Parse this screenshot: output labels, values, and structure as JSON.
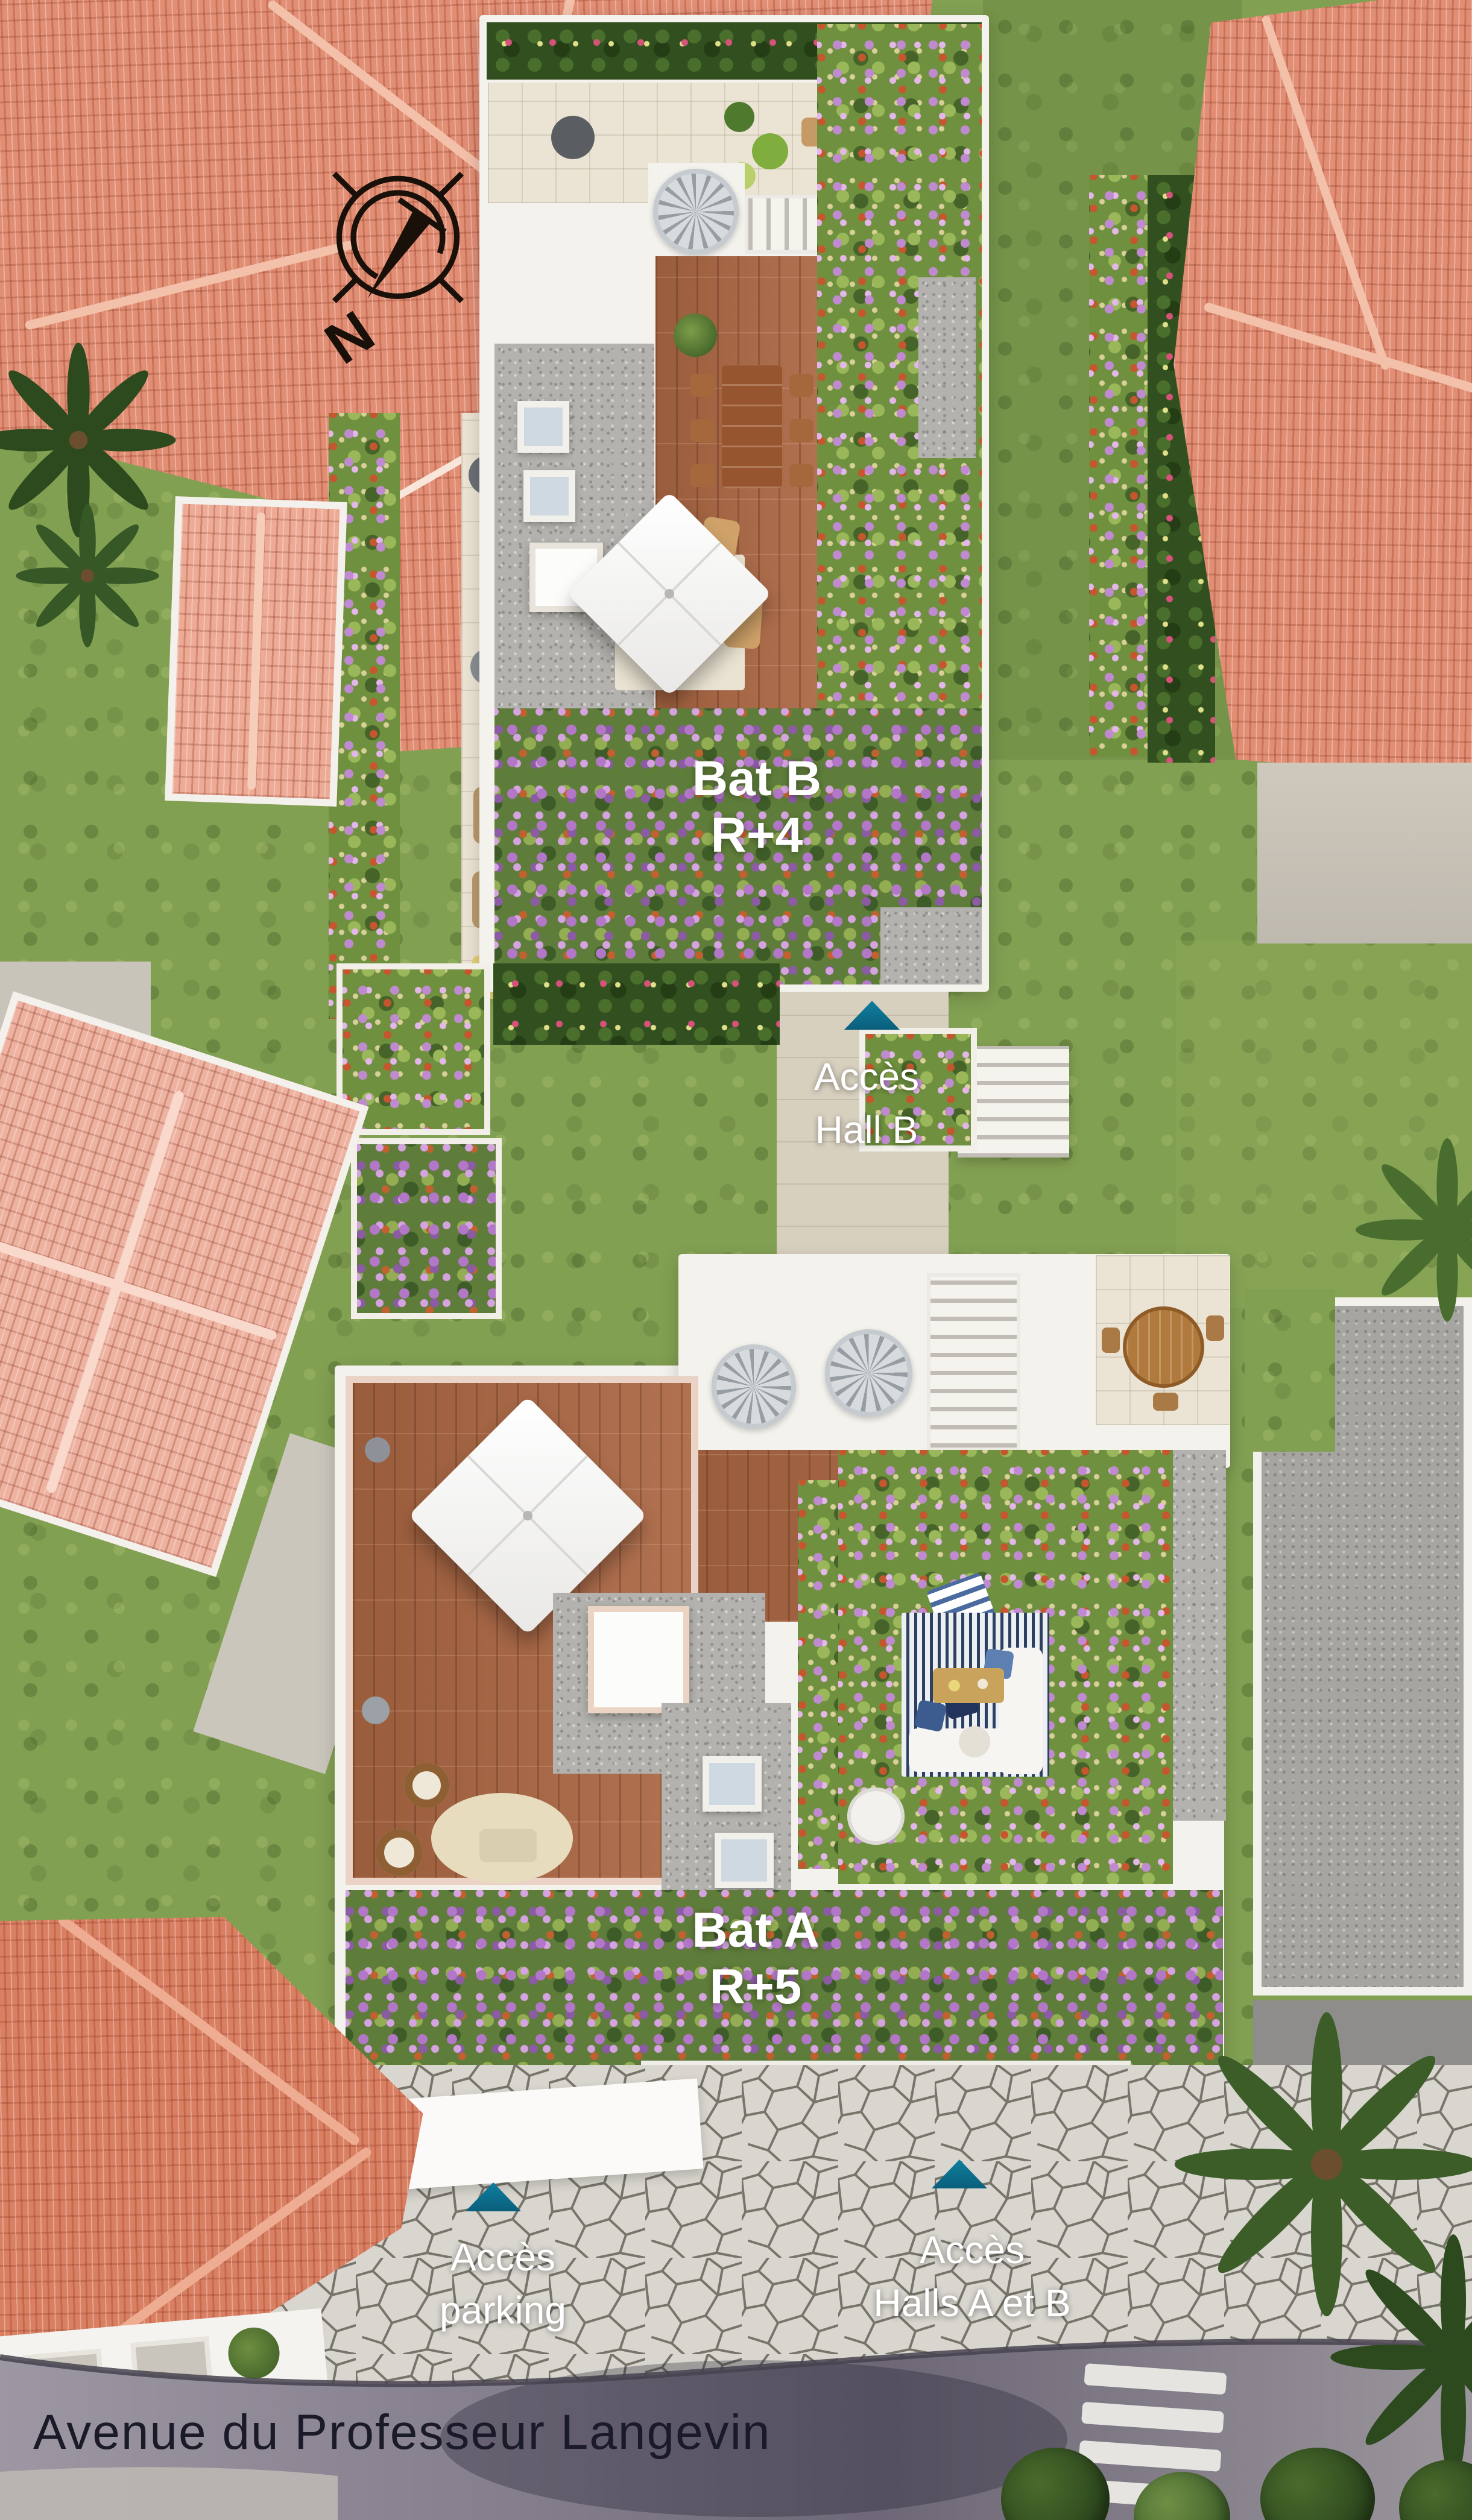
{
  "meta": {
    "view": "aerial residence site plan"
  },
  "palette": {
    "accent_teal": "#0d7390",
    "label_white": "#ffffff",
    "street_text": "#1a1a28",
    "roof_terracotta": "#e18e74",
    "roof_pink": "#eeb2a1",
    "grass_green": "#82a052",
    "deck_wood": "#ab6743",
    "roof_gravel": "#b4b2ae",
    "stone_paving": "#d9d6cf",
    "road_asphalt": "#847e8d"
  },
  "compass": {
    "letter": "N"
  },
  "buildings": [
    {
      "id": "bat-b",
      "name": "Bat B",
      "floors": "R+4"
    },
    {
      "id": "bat-a",
      "name": "Bat A",
      "floors": "R+5"
    }
  ],
  "access_markers": [
    {
      "id": "hall-b",
      "line1": "Accès",
      "line2": "Hall B"
    },
    {
      "id": "parking",
      "line1": "Accès",
      "line2": "parking"
    },
    {
      "id": "halls-a-b",
      "line1": "Accès",
      "line2": "Halls A et B"
    }
  ],
  "street": {
    "name": "Avenue du Professeur Langevin"
  }
}
